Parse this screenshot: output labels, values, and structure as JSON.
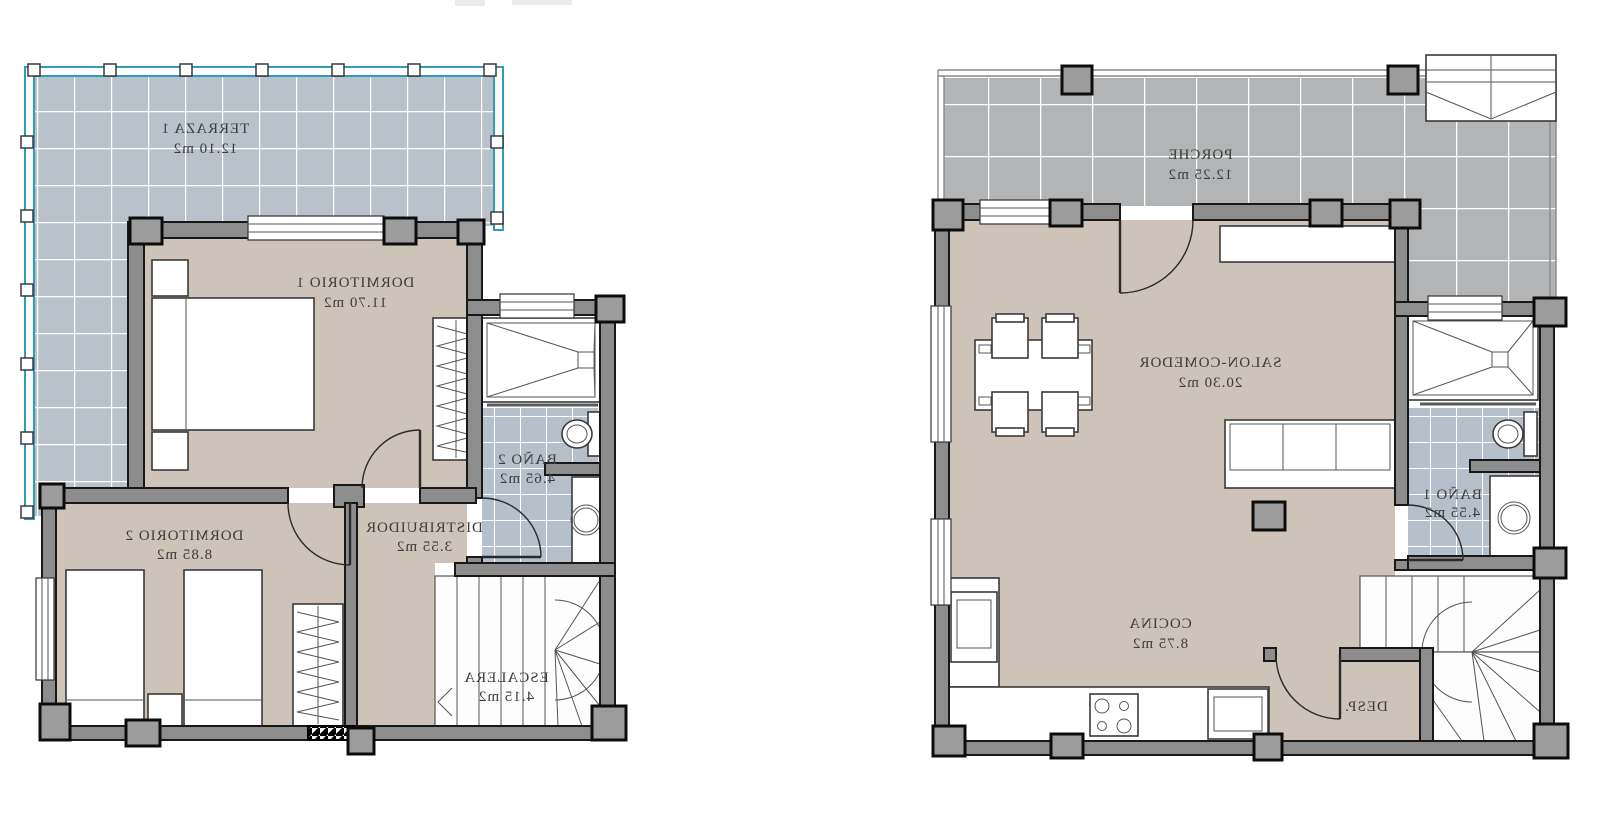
{
  "document": {
    "kind": "architectural floor plan drawing",
    "units_suffix": "m2",
    "text_is_mirrored": true
  },
  "colors": {
    "floor_beige": "#cdc3b8",
    "wall_gray": "#8d8d8d",
    "wall_outline": "#181818",
    "pillar_gray": "#9c9c9c",
    "terrace_tile": "#b9c2ca",
    "bath_tile": "#b5c0ca",
    "porch_tile": "#b2b4b5",
    "railing_cyan": "#2f9cba",
    "label_text": "#3c3c3c"
  },
  "plans": [
    {
      "id": "upper-floor",
      "rooms": [
        {
          "name": "TERRAZA 1",
          "area": "12.10 m2"
        },
        {
          "name": "DORMITORIO 1",
          "area": "11.70 m2"
        },
        {
          "name": "BAÑO 2",
          "area": "4.65 m2"
        },
        {
          "name": "DISTRIBUIDOR",
          "area": "3.55 m2"
        },
        {
          "name": "DORMITORIO 2",
          "area": "8.85 m2"
        },
        {
          "name": "ESCALERA",
          "area": "4.15 m2"
        }
      ]
    },
    {
      "id": "ground-floor",
      "rooms": [
        {
          "name": "PORCHE",
          "area": "12.25 m2"
        },
        {
          "name": "SALON-COMEDOR",
          "area": "20.30 m2"
        },
        {
          "name": "BAÑO 1",
          "area": "4.55 m2"
        },
        {
          "name": "COCINA",
          "area": "8.75 m2"
        },
        {
          "name": "DESP.",
          "area": ""
        }
      ]
    }
  ]
}
